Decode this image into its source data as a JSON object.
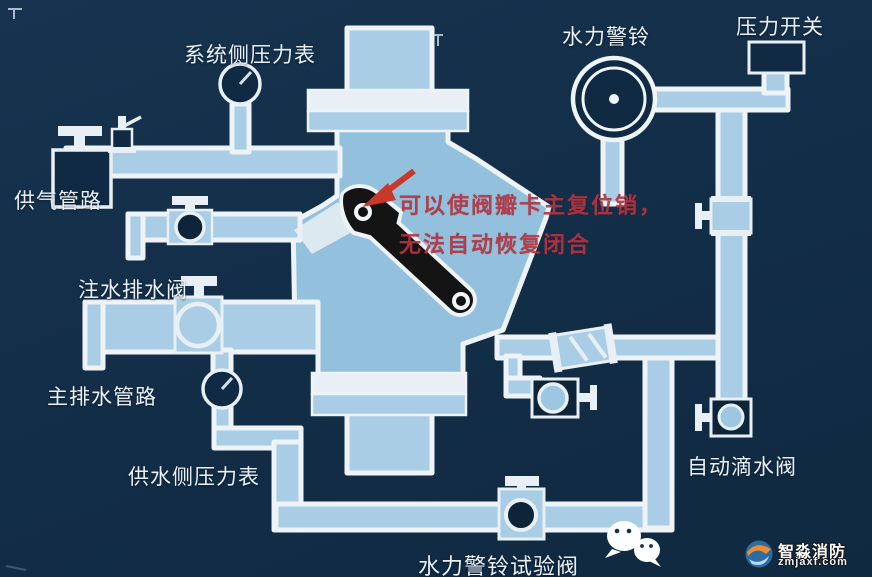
{
  "labels": {
    "system_gauge": {
      "text": "系统侧压力表"
    },
    "water_alarm": {
      "text": "水力警铃"
    },
    "pressure_switch": {
      "text": "压力开关"
    },
    "air_supply": {
      "text": "供气管路"
    },
    "fill_drain": {
      "text": "注水排水阀"
    },
    "main_drain": {
      "text": "主排水管路"
    },
    "supply_gauge": {
      "text": "供水侧压力表"
    },
    "drip_valve": {
      "text": "自动滴水阀"
    },
    "test_valve": {
      "text": "水力警铃试验阀"
    }
  },
  "annotation": {
    "line1": "可以使阀瓣卡主复位销，",
    "line2": "无法自动恢复闭合",
    "color": "#b53340"
  },
  "watermark": {
    "brand": "智淼消防",
    "domain": "zmjaxf.com"
  },
  "icons": {
    "wechat": "wechat-icon"
  },
  "colors": {
    "background": "#14304a",
    "pipe": "#a9cde5",
    "valve_body": "#93c1dd",
    "outline": "#edf3f7",
    "component_dark": "#0f2a42",
    "clapper_black": "#141414",
    "arrow_red": "#c8392b",
    "annotation_red": "#b53340",
    "watermark_orange": "#ef8b2c"
  }
}
